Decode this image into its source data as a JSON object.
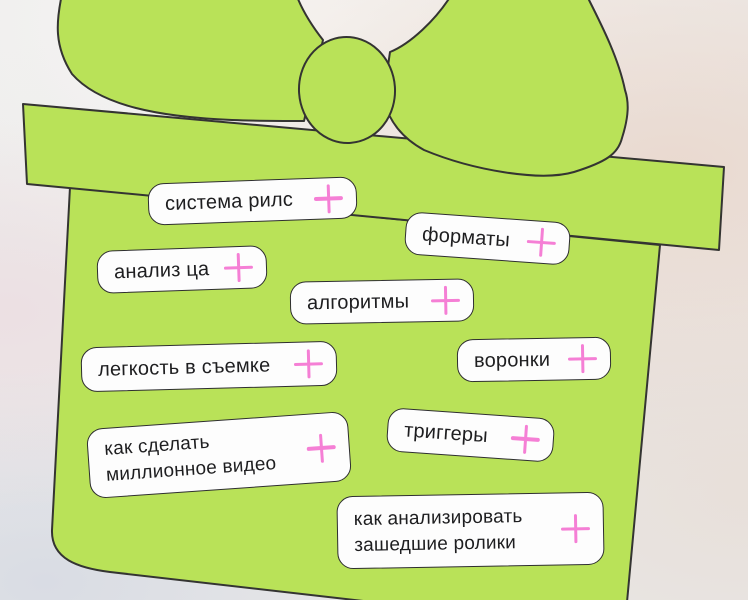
{
  "colors": {
    "box_green": "#b9e258",
    "outline": "#343432",
    "pill_bg": "#fdfdfd",
    "pill_text": "#1e1e20",
    "plus_pink": "#f57fd5"
  },
  "illustration": {
    "shapes": [
      "bow-left-loop",
      "bow-right-loop",
      "bow-knot",
      "gift-box-lid",
      "gift-box-body"
    ]
  },
  "tags": [
    {
      "label": "система рилс"
    },
    {
      "label": "форматы"
    },
    {
      "label": "анализ ца"
    },
    {
      "label": "алгоритмы"
    },
    {
      "label": "легкость в съемке"
    },
    {
      "label": "воронки"
    },
    {
      "lines": [
        "как сделать",
        "миллионное видео"
      ]
    },
    {
      "label": "триггеры"
    },
    {
      "lines": [
        "как анализировать",
        "зашедшие ролики"
      ]
    }
  ]
}
